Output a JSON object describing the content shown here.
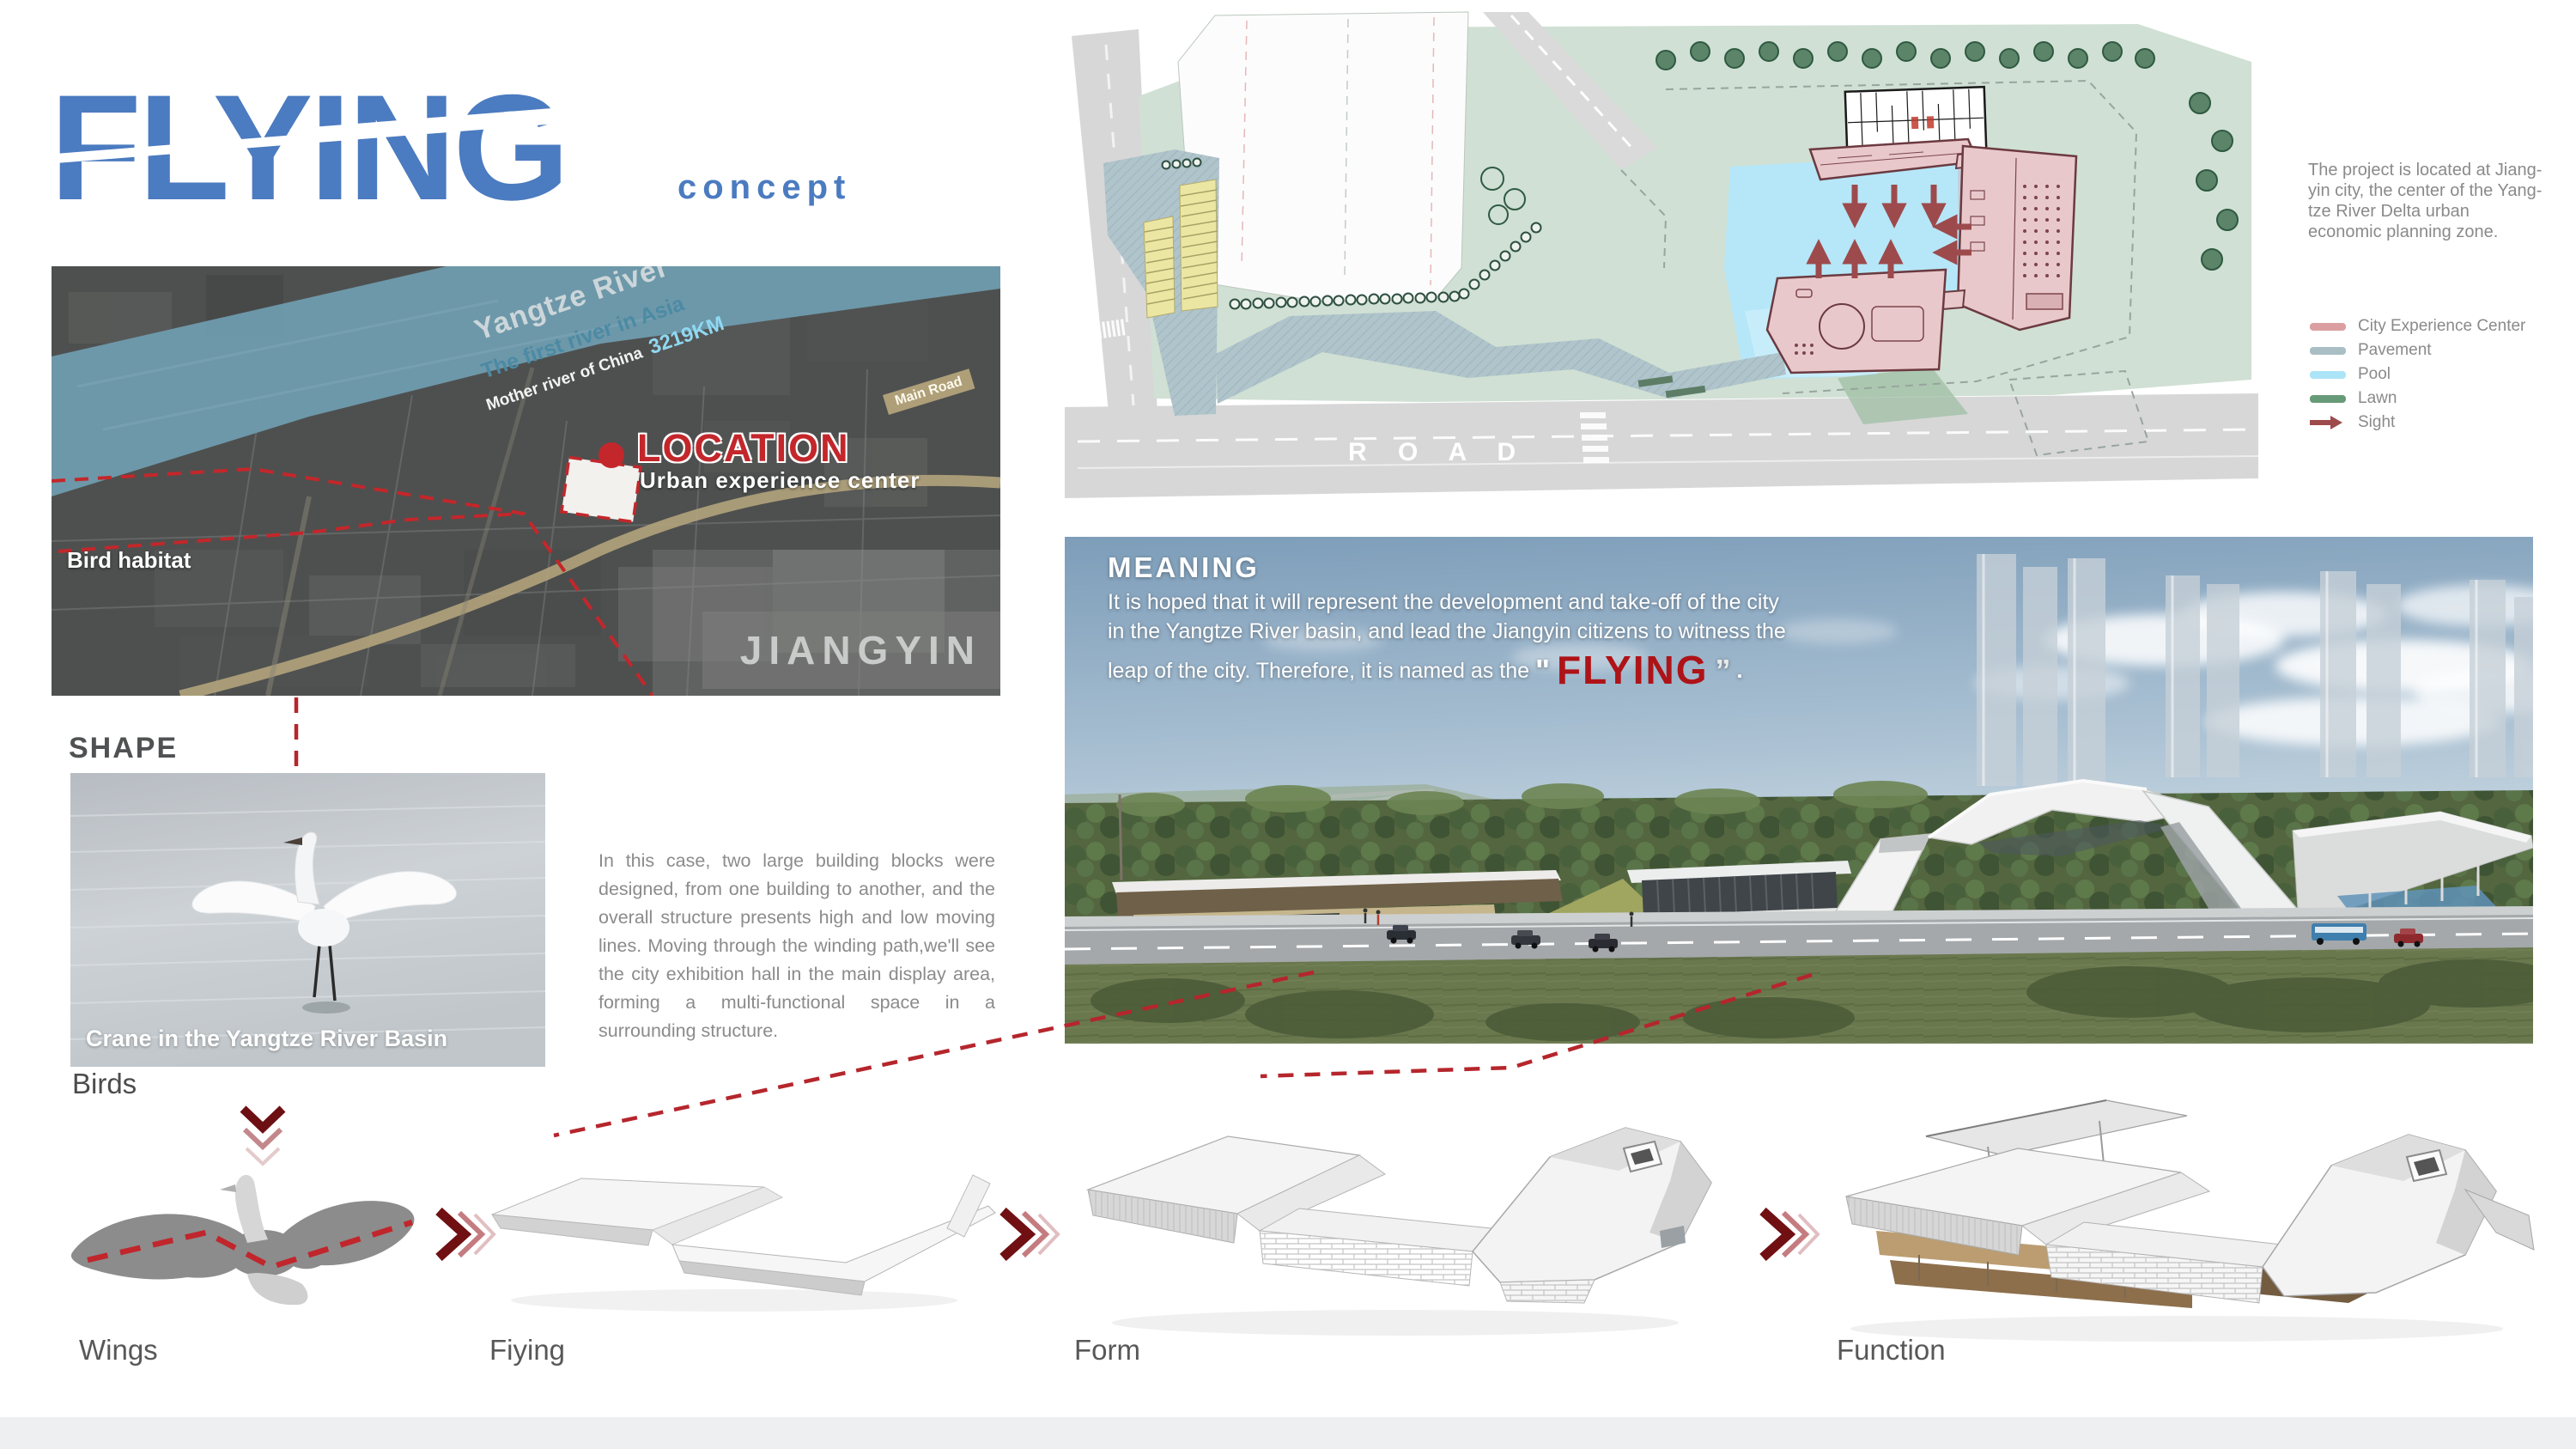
{
  "logo": {
    "title": "FLYING",
    "subtitle": "concept"
  },
  "map": {
    "river_title": "Yangtze River",
    "river_subtitle": "The first river in Asia",
    "river_caption": "Mother river of China",
    "river_length": "3219KM",
    "road_label": "Main Road",
    "location_title": "LOCATION",
    "location_subtitle": "Urban experience center",
    "habitat_label": "Bird habitat",
    "city_label": "JIANGYIN"
  },
  "shape": {
    "heading": "SHAPE",
    "photo_caption": "Crane in the Yangtze River Basin",
    "photo_label": "Birds",
    "description": "In this case, two large building blocks were designed, from one building to another, and the overall structure presents high and low moving lines. Moving through the winding path,we'll see the city exhibition hall in the main display area, forming a multi-functional space in a surrounding structure."
  },
  "site_plan": {
    "road_label": "R O A D",
    "description": "The project is located at Jiang-yin city, the center of the Yang-tze River Delta urban economic planning zone.",
    "legend_items": [
      {
        "label": "City Experience Center",
        "color": "#db9fa2"
      },
      {
        "label": "Pavement",
        "color": "#a9bec5"
      },
      {
        "label": "Pool",
        "color": "#ace4f7"
      },
      {
        "label": "Lawn",
        "color": "#679a78"
      },
      {
        "label": "Sight",
        "color": "#9d4a4c"
      }
    ]
  },
  "meaning": {
    "heading": "MEANING",
    "line1": "It is hoped that it will represent the development and take-off of the city",
    "line2": "in the Yangtze River basin, and lead the Jiangyin citizens to witness the",
    "line3": "leap of the city. Therefore, it is named as the",
    "quote_open": "\"",
    "highlight": "FLYING",
    "quote_close": "”",
    "suffix": "."
  },
  "process": {
    "steps": [
      {
        "label": "Wings"
      },
      {
        "label": "Fiying"
      },
      {
        "label": "Form"
      },
      {
        "label": "Function"
      }
    ]
  },
  "colors": {
    "logo_blue": "#4b7bc0",
    "accent_red": "#c3272b",
    "dashed_red": "#b5262c",
    "highlight_red": "#ae1317",
    "chevron_dark": "#701013"
  }
}
